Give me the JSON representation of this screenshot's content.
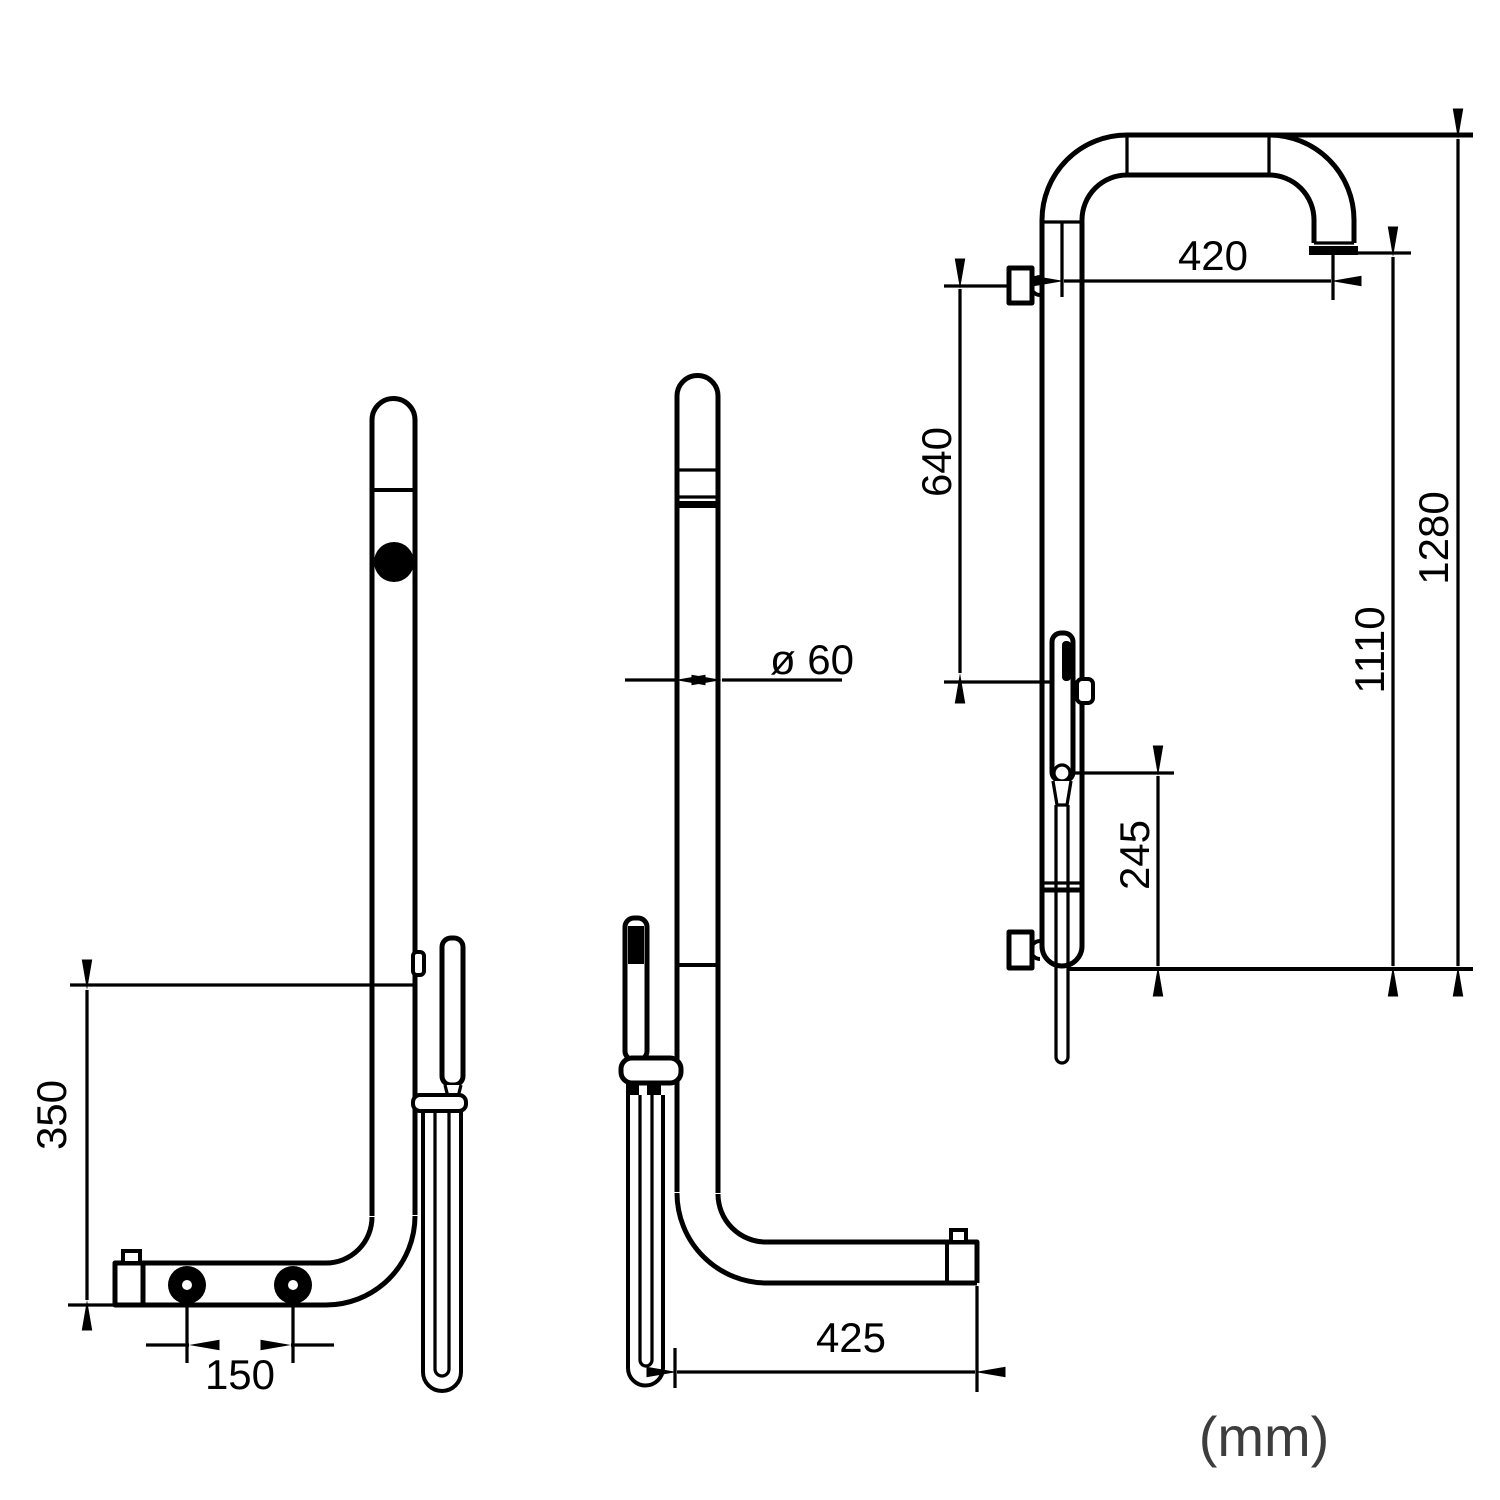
{
  "drawing": {
    "background": "#ffffff",
    "line_color": "#000000",
    "dimensions": {
      "left_height": "350",
      "left_hole_spacing": "150",
      "middle_diameter": "ø 60",
      "middle_depth": "425",
      "right_arm_reach": "420",
      "right_valve_to_holder": "640",
      "right_spout_height": "1110",
      "right_total_height": "1280",
      "right_holder_height": "245"
    },
    "units_note": {
      "label": "(mm)",
      "color": "#3d3d3d"
    }
  }
}
